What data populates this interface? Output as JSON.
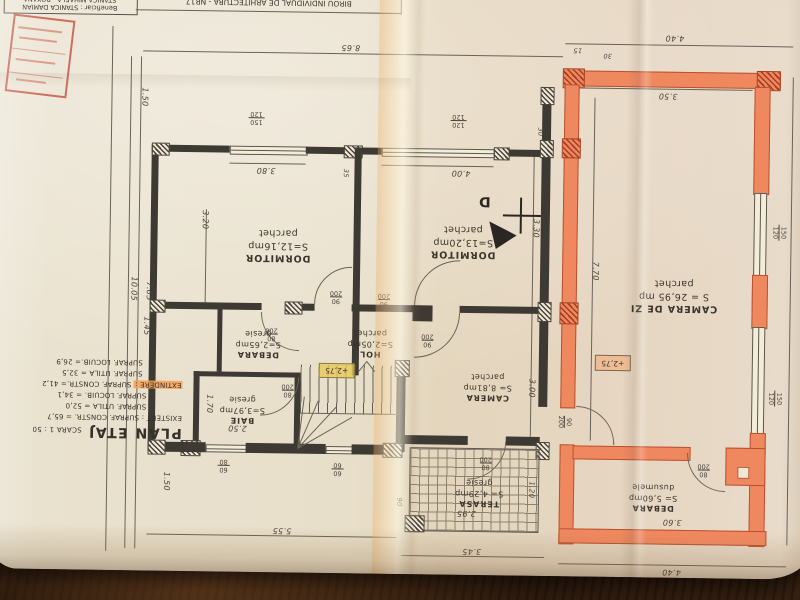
{
  "photo": {
    "description": "Architectural floor-plan sheet photographed upside-down on a wooden table"
  },
  "header": {
    "office": "BIROU INDIVIDUAL DE ARHITECTURA - NR17",
    "beneficiary_line1": "Beneficiar : STANICA DAMIAN",
    "beneficiary_line2": "STANICA MIHAELA - ROXANA"
  },
  "legend": {
    "title": "PLAN ETAJ",
    "scale": "SCARA 1 : 50",
    "existent_constr": "EXISTENT : SUPRAF. CONSTR. = 65,7",
    "existent_utila": "SUPRAF. UTILA = 52,0",
    "existent_locuib": "SUPRAF. LOCUIB. = 34,1",
    "extindere_label": "EXTINDERE :",
    "extindere_constr": " SUPRAF. CONSTR.= 41,2",
    "extindere_utila": "SUPRAF. UTILA = 32,5",
    "extindere_locuib": "SUPRAF. LOCUIB.= 26,9"
  },
  "rooms": {
    "dorm1": {
      "name": "DORMITOR",
      "area": "S=12,16mp",
      "finish": "parchet"
    },
    "dorm2": {
      "name": "DORMITOR",
      "area": "S=13,20mp",
      "finish": "parchet"
    },
    "living": {
      "name": "CAMERA DE ZI",
      "area": "S = 26,95 mp",
      "finish": "parchet"
    },
    "hol": {
      "name": "HOL",
      "area": "S=2,05mp",
      "finish": "parchet"
    },
    "debara1": {
      "name": "DEBARA",
      "area": "S=2,65mp",
      "finish": "gresie"
    },
    "baie": {
      "name": "BAIE",
      "area": "S=3,97mp",
      "finish": "gresie"
    },
    "camera": {
      "name": "CAMERA",
      "area": "S= 8,81mp",
      "finish": "parchet"
    },
    "terasa": {
      "name": "TERASA",
      "area": "S= 4,29mp",
      "finish": "gresie"
    },
    "debara2": {
      "name": "DEBARA",
      "area": "S= 5,60mp",
      "finish": "dusumele"
    }
  },
  "levels": {
    "hol": "+2,75",
    "living": "+2,75"
  },
  "section": {
    "label": "D"
  },
  "dims": {
    "overall_top": "8.65",
    "ext_top": "4.40",
    "t15": "15",
    "t30": "30",
    "t30b": "30",
    "t35": "35",
    "dorm1_win": "3.80",
    "dorm2_win": "4.00",
    "living_top": "3.50",
    "left_overall": "10.05",
    "left_705": "7.05",
    "left_320": "3.20",
    "left_145": "1.45",
    "left_150a": "1.50",
    "left_150b": "1.50",
    "baie_w": "2.50",
    "baie_h": "1.70",
    "camera_h": "3.00",
    "dorm2_h": "3.30",
    "living_h": "7.70",
    "terasa_w": "2.95",
    "terasa_90": "90",
    "terasa_120": "1.20",
    "bottom_345": "3.45",
    "bottom_555": "5.55",
    "debara2_w": "3.60",
    "ext_bottom": "4.40"
  },
  "openings": {
    "door80": {
      "w": "80",
      "h": "200"
    },
    "door90": {
      "w": "90",
      "h": "200"
    },
    "win150": {
      "w": "150",
      "h": "120"
    },
    "win120": {
      "w": "120",
      "h": "120"
    },
    "win6080": {
      "w": "60",
      "h": "80"
    },
    "win6060": {
      "w": "60",
      "h": "60"
    }
  },
  "colors": {
    "extension_wall": "#f0885f",
    "extindere_highlight": "#f5a055",
    "level_highlight": "#e9c95a",
    "stamp": "#c0392b",
    "paper": "#e7dfc9",
    "ink": "#3d3933",
    "table": "#2e1b0e"
  }
}
